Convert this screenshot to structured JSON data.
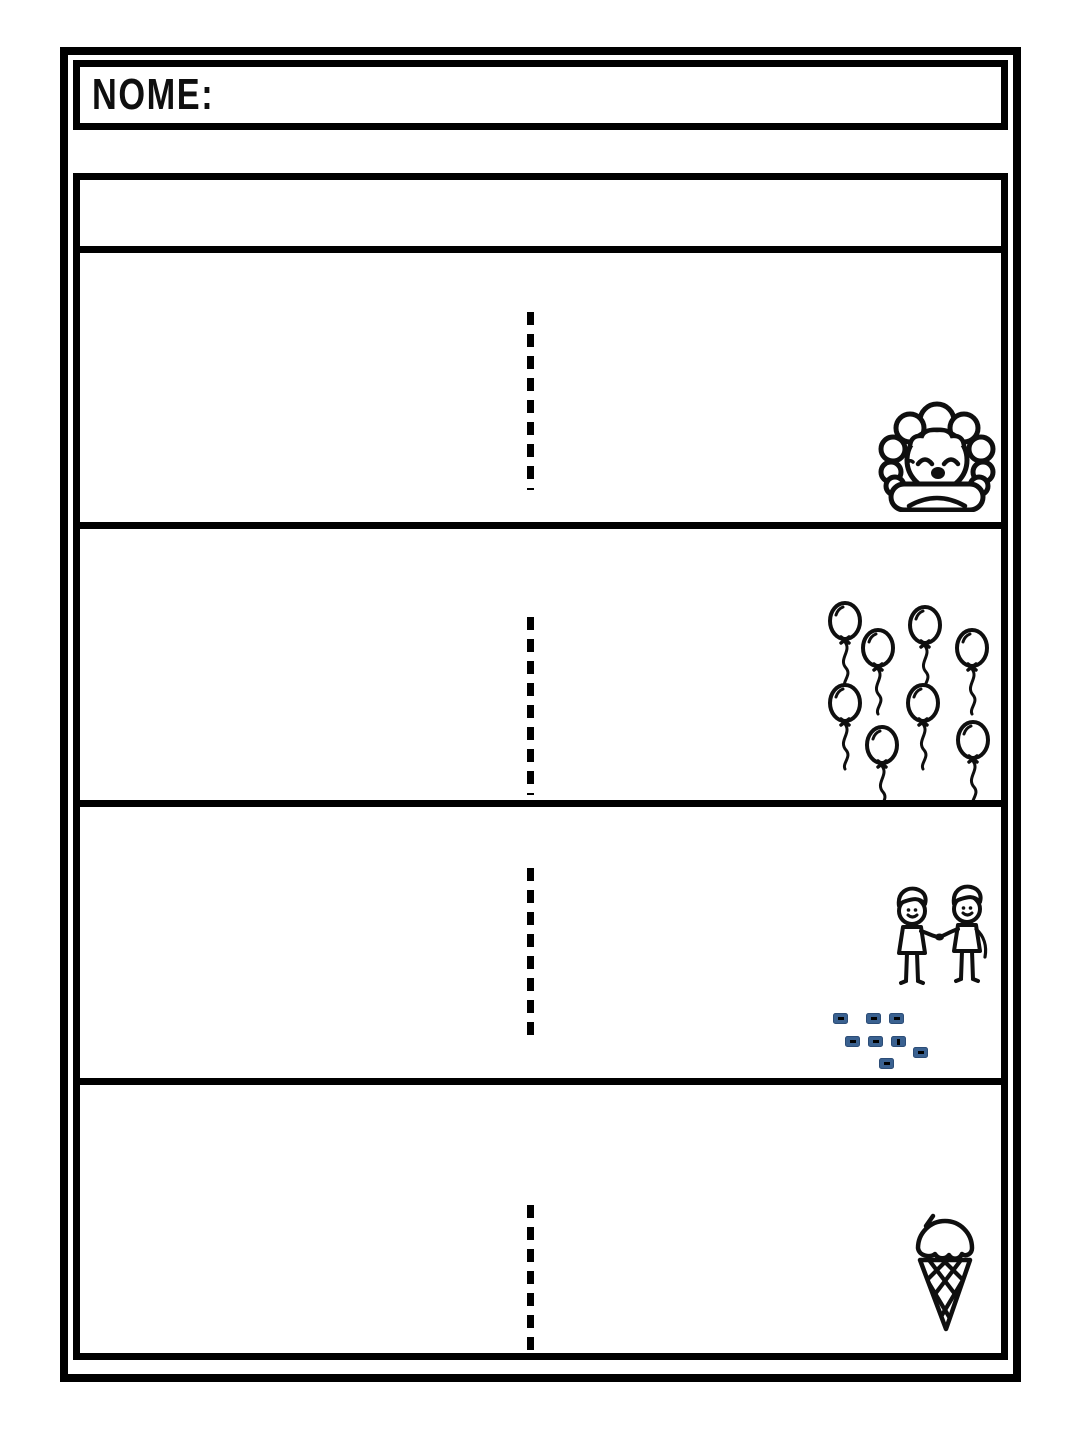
{
  "header": {
    "name_label": "NOME:"
  },
  "instruction_row": {
    "text": ""
  },
  "colors": {
    "ink": "#000000",
    "paper": "#ffffff",
    "mark_fill": "#3a6190",
    "mark_border": "#2c4d77"
  },
  "exercise_rows": [
    {
      "picture": "curly-haired-child",
      "icon": "curly-haired-child-icon",
      "item_count": 1
    },
    {
      "picture": "balloons",
      "icon": "balloons-icon",
      "item_count": 8
    },
    {
      "picture": "children-shaking-hands",
      "icon": "children-shaking-hands-icon",
      "item_count": 2,
      "blue_marks": {
        "count": 8
      }
    },
    {
      "picture": "ice-cream-cone",
      "icon": "ice-cream-cone-icon",
      "item_count": 1
    }
  ],
  "guides": {
    "style": "vertical-dashed-line",
    "per_row": 4
  }
}
